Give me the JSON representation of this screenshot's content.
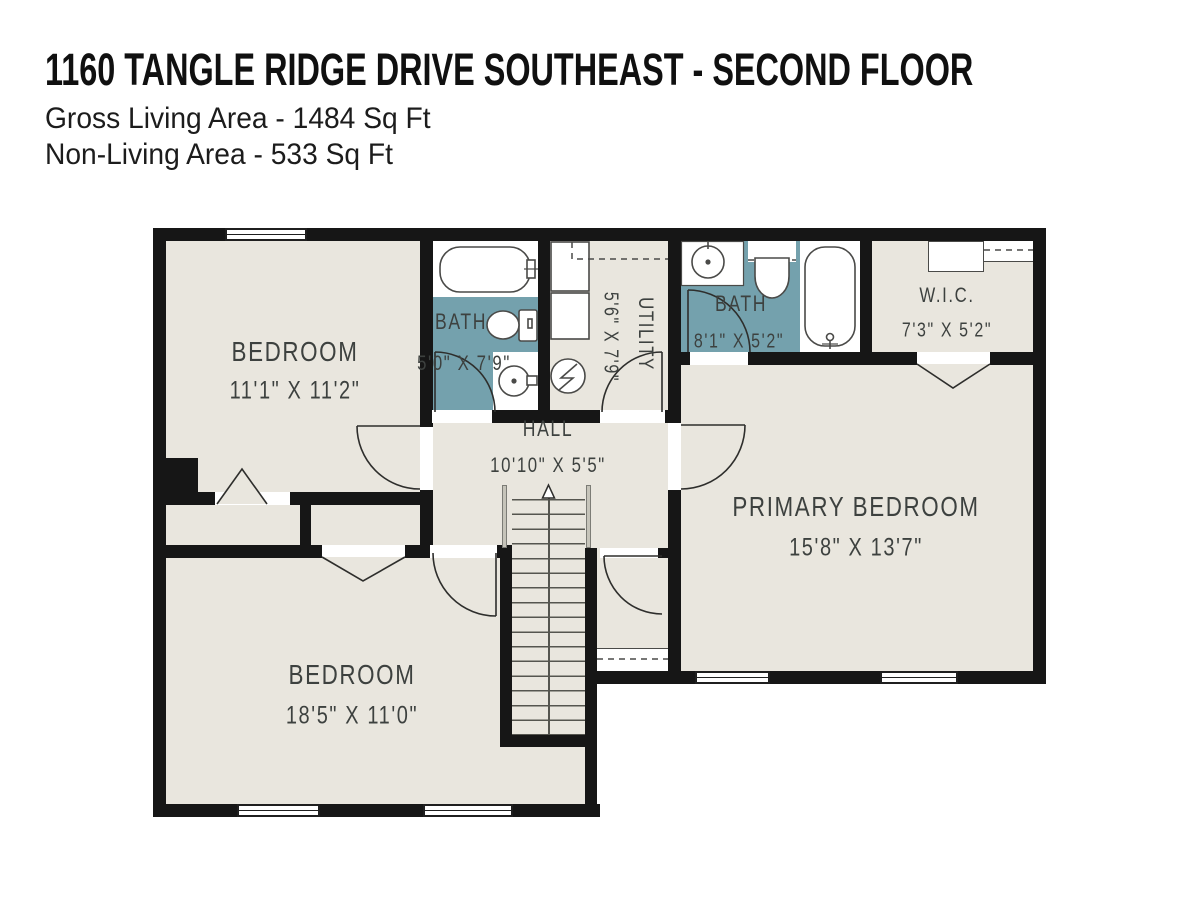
{
  "header": {
    "title": "1160 TANGLE RIDGE DRIVE SOUTHEAST - SECOND FLOOR",
    "subtitle_line1": "Gross Living Area - 1484 Sq Ft",
    "subtitle_line2": "Non-Living Area - 533 Sq Ft"
  },
  "rooms": {
    "bedroom_top": {
      "name": "BEDROOM",
      "dims": "11'1\" X 11'2\""
    },
    "bath_main": {
      "name": "BATH",
      "dims": "5'0\" X 7'9\""
    },
    "utility": {
      "name": "UTILITY",
      "dims": "5'6\" X 7'9\""
    },
    "bath_primary": {
      "name": "BATH",
      "dims": "8'1\" X 5'2\""
    },
    "wic": {
      "name": "W.I.C.",
      "dims": "7'3\" X 5'2\""
    },
    "hall": {
      "name": "HALL",
      "dims": "10'10\" X 5'5\""
    },
    "primary_bedroom": {
      "name": "PRIMARY BEDROOM",
      "dims": "15'8\" X 13'7\""
    },
    "bedroom_bottom": {
      "name": "BEDROOM",
      "dims": "18'5\" X 11'0\""
    }
  },
  "colors": {
    "wall": "#161616",
    "floor": "#e9e6de",
    "wet_floor": "#74a1ad",
    "label": "#3d413f"
  }
}
